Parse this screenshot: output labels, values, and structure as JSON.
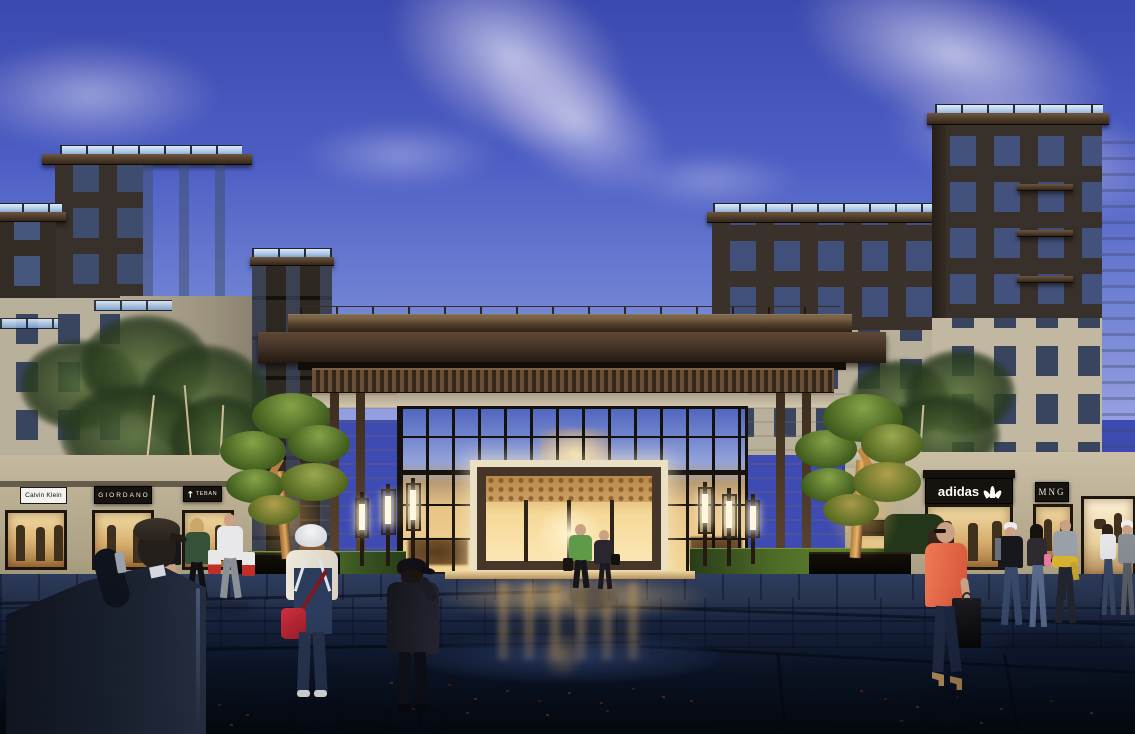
{
  "scene": {
    "type": "architectural rendering",
    "setting": "Mixed-use residential complex with glass lobby entrance and retail shops, evening dusk plaza scene",
    "sky": "deep blue evening sky with wispy clouds"
  },
  "signs": {
    "calvin_klein": "Calvin Klein",
    "giordano": "GIORDANO",
    "teban": "TEBAN",
    "adidas": "adidas",
    "mng": "MNG"
  },
  "colors": {
    "sky_top": "#3d4bb2",
    "sky_horizon": "#95a0e0",
    "facade_cream": "#cdc5b2",
    "facade_dark": "#362e26",
    "roof_brown": "#4a3826",
    "glass_reflection": "#5d74c8",
    "interior_glow": "#f2d694",
    "lawn_green": "#3a5522",
    "pavement_navy": "#0d1527",
    "accent_red_bag": "#bf2633",
    "accent_coral": "#e86848"
  },
  "people": [
    "Man in dark suit and cap talking on phone, foreground left, back view",
    "Family with child carrying shopping bags walking past the left shops",
    "Woman in white cap and denim overalls with red crossbody bag, back view",
    "Boy in black cap and dark jacket walking toward the lobby, back view",
    "Couple walking out of the lit lobby entrance",
    "Woman in coral top carrying a black shopping bag, foreground right",
    "Group of shoppers near the adidas store",
    "Couple walking at the far right corner"
  ]
}
